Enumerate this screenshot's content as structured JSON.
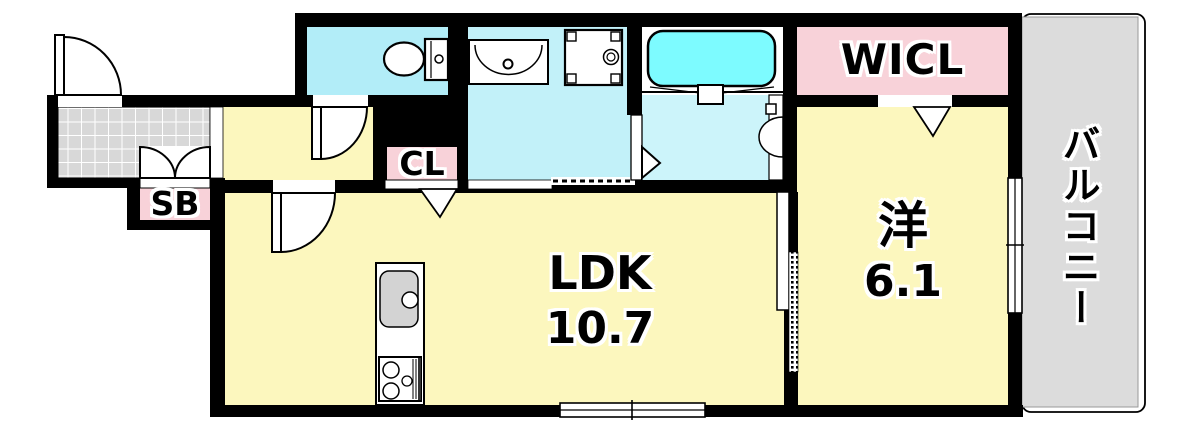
{
  "floorplan": {
    "rooms": [
      {
        "id": "ldk",
        "name": "LDK",
        "area": "10.7"
      },
      {
        "id": "western_room",
        "name": "洋",
        "area": "6.1"
      },
      {
        "id": "walk_in_closet",
        "name": "WICL"
      },
      {
        "id": "closet",
        "name": "CL"
      },
      {
        "id": "shoe_box",
        "name": "SB"
      },
      {
        "id": "balcony",
        "name": "バルコニー"
      }
    ],
    "symbols": [
      "entry-door-swing",
      "shoe-box-double-doors",
      "toilet",
      "vanity-sink",
      "washing-machine-pan",
      "bathtub",
      "bath-folding-door",
      "kitchen-sink",
      "gas-stove",
      "sliding-door",
      "hinged-door-swing",
      "folding-closet-door",
      "sliding-window",
      "balcony-railing",
      "tiled-entrance-floor"
    ],
    "colors": {
      "room_yellow": "#fcf7be",
      "closet_pink": "#f8d2d9",
      "toilet_cyan": "#b2edf8",
      "washroom_cyan": "#c2f1f9",
      "bath_floor_cyan": "#ccf4fa",
      "bathtub_cyan": "#7dfbff",
      "balcony_gray": "#dcdcdc",
      "entrance_tile_gray": "#d8d8d8",
      "wall_black": "#000000"
    }
  }
}
